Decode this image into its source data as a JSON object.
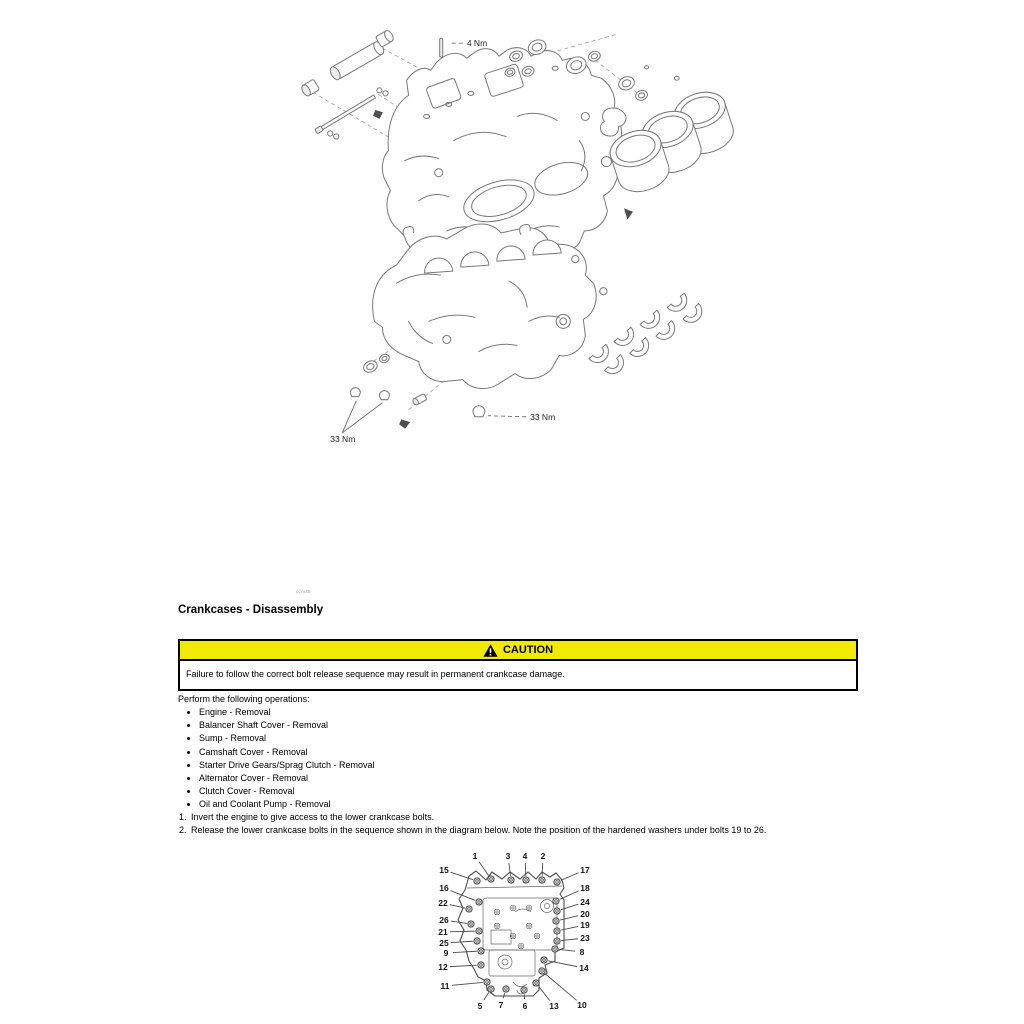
{
  "page": {
    "figure_ref": "ccni45",
    "section_title": "Crankcases - Disassembly",
    "caution": {
      "label": "CAUTION",
      "text": "Failure to follow the correct bolt release sequence may result in permanent crankcase damage."
    },
    "intro": "Perform the following operations:",
    "operations": [
      "Engine - Removal",
      "Balancer Shaft Cover - Removal",
      "Sump - Removal",
      "Camshaft Cover - Removal",
      "Starter Drive Gears/Sprag Clutch - Removal",
      "Alternator Cover - Removal",
      "Clutch Cover - Removal",
      "Oil and Coolant Pump - Removal"
    ],
    "steps": [
      {
        "num": "1.",
        "text": "Invert the engine to give access to the lower crankcase bolts."
      },
      {
        "num": "2.",
        "text": "Release the lower crankcase bolts in the sequence shown in the diagram below. Note the position of the hardened washers under bolts 19 to 26."
      }
    ]
  },
  "exploded_diagram": {
    "torque_labels": [
      {
        "text": "4 Nm",
        "x": 188,
        "y": 26,
        "leaders": [
          {
            "x1": 184,
            "y1": 23,
            "x2": 170,
            "y2": 23,
            "dash": true
          }
        ]
      },
      {
        "text": "33 Nm",
        "x": 52,
        "y": 420,
        "leaders": [
          {
            "x1": 64,
            "y1": 411,
            "x2": 78,
            "y2": 379,
            "dash": false
          },
          {
            "x1": 64,
            "y1": 411,
            "x2": 104,
            "y2": 381,
            "dash": false
          }
        ]
      },
      {
        "text": "33 Nm",
        "x": 251,
        "y": 398,
        "leaders": [
          {
            "x1": 247,
            "y1": 395,
            "x2": 209,
            "y2": 394,
            "dash": true
          }
        ]
      }
    ]
  },
  "bolt_diagram": {
    "labels": [
      {
        "n": "1",
        "lx": 46,
        "ly": 14,
        "bx": 62,
        "by": 37
      },
      {
        "n": "3",
        "lx": 79,
        "ly": 14,
        "bx": 82,
        "by": 38
      },
      {
        "n": "4",
        "lx": 96,
        "ly": 14,
        "bx": 97,
        "by": 38
      },
      {
        "n": "2",
        "lx": 114,
        "ly": 14,
        "bx": 113,
        "by": 38
      },
      {
        "n": "15",
        "lx": 15,
        "ly": 28,
        "bx": 48,
        "by": 39
      },
      {
        "n": "17",
        "lx": 156,
        "ly": 28,
        "bx": 128,
        "by": 40
      },
      {
        "n": "16",
        "lx": 15,
        "ly": 46,
        "bx": 50,
        "by": 60
      },
      {
        "n": "18",
        "lx": 156,
        "ly": 46,
        "bx": 127,
        "by": 59
      },
      {
        "n": "22",
        "lx": 14,
        "ly": 61,
        "bx": 40,
        "by": 67
      },
      {
        "n": "24",
        "lx": 156,
        "ly": 60,
        "bx": 128,
        "by": 69
      },
      {
        "n": "26",
        "lx": 15,
        "ly": 78,
        "bx": 42,
        "by": 82
      },
      {
        "n": "20",
        "lx": 156,
        "ly": 72,
        "bx": 127,
        "by": 79
      },
      {
        "n": "21",
        "lx": 14,
        "ly": 90,
        "bx": 50,
        "by": 89
      },
      {
        "n": "19",
        "lx": 156,
        "ly": 83,
        "bx": 128,
        "by": 89
      },
      {
        "n": "25",
        "lx": 15,
        "ly": 101,
        "bx": 48,
        "by": 99
      },
      {
        "n": "23",
        "lx": 156,
        "ly": 96,
        "bx": 128,
        "by": 99
      },
      {
        "n": "9",
        "lx": 17,
        "ly": 111,
        "bx": 52,
        "by": 109
      },
      {
        "n": "8",
        "lx": 153,
        "ly": 110,
        "bx": 126,
        "by": 107
      },
      {
        "n": "12",
        "lx": 14,
        "ly": 125,
        "bx": 52,
        "by": 123
      },
      {
        "n": "14",
        "lx": 155,
        "ly": 126,
        "bx": 115,
        "by": 118
      },
      {
        "n": "11",
        "lx": 16,
        "ly": 144,
        "bx": 58,
        "by": 140
      },
      {
        "n": "10",
        "lx": 153,
        "ly": 163,
        "bx": 113,
        "by": 129
      },
      {
        "n": "5",
        "lx": 51,
        "ly": 164,
        "bx": 62,
        "by": 147
      },
      {
        "n": "7",
        "lx": 72,
        "ly": 163,
        "bx": 77,
        "by": 147
      },
      {
        "n": "6",
        "lx": 96,
        "ly": 164,
        "bx": 95,
        "by": 148
      },
      {
        "n": "13",
        "lx": 125,
        "ly": 164,
        "bx": 107,
        "by": 141
      }
    ]
  },
  "colors": {
    "caution_yellow": "#f2ea00",
    "diagram_line": "#7a7a7a",
    "bolt_diagram_line": "#4d4d4d"
  }
}
